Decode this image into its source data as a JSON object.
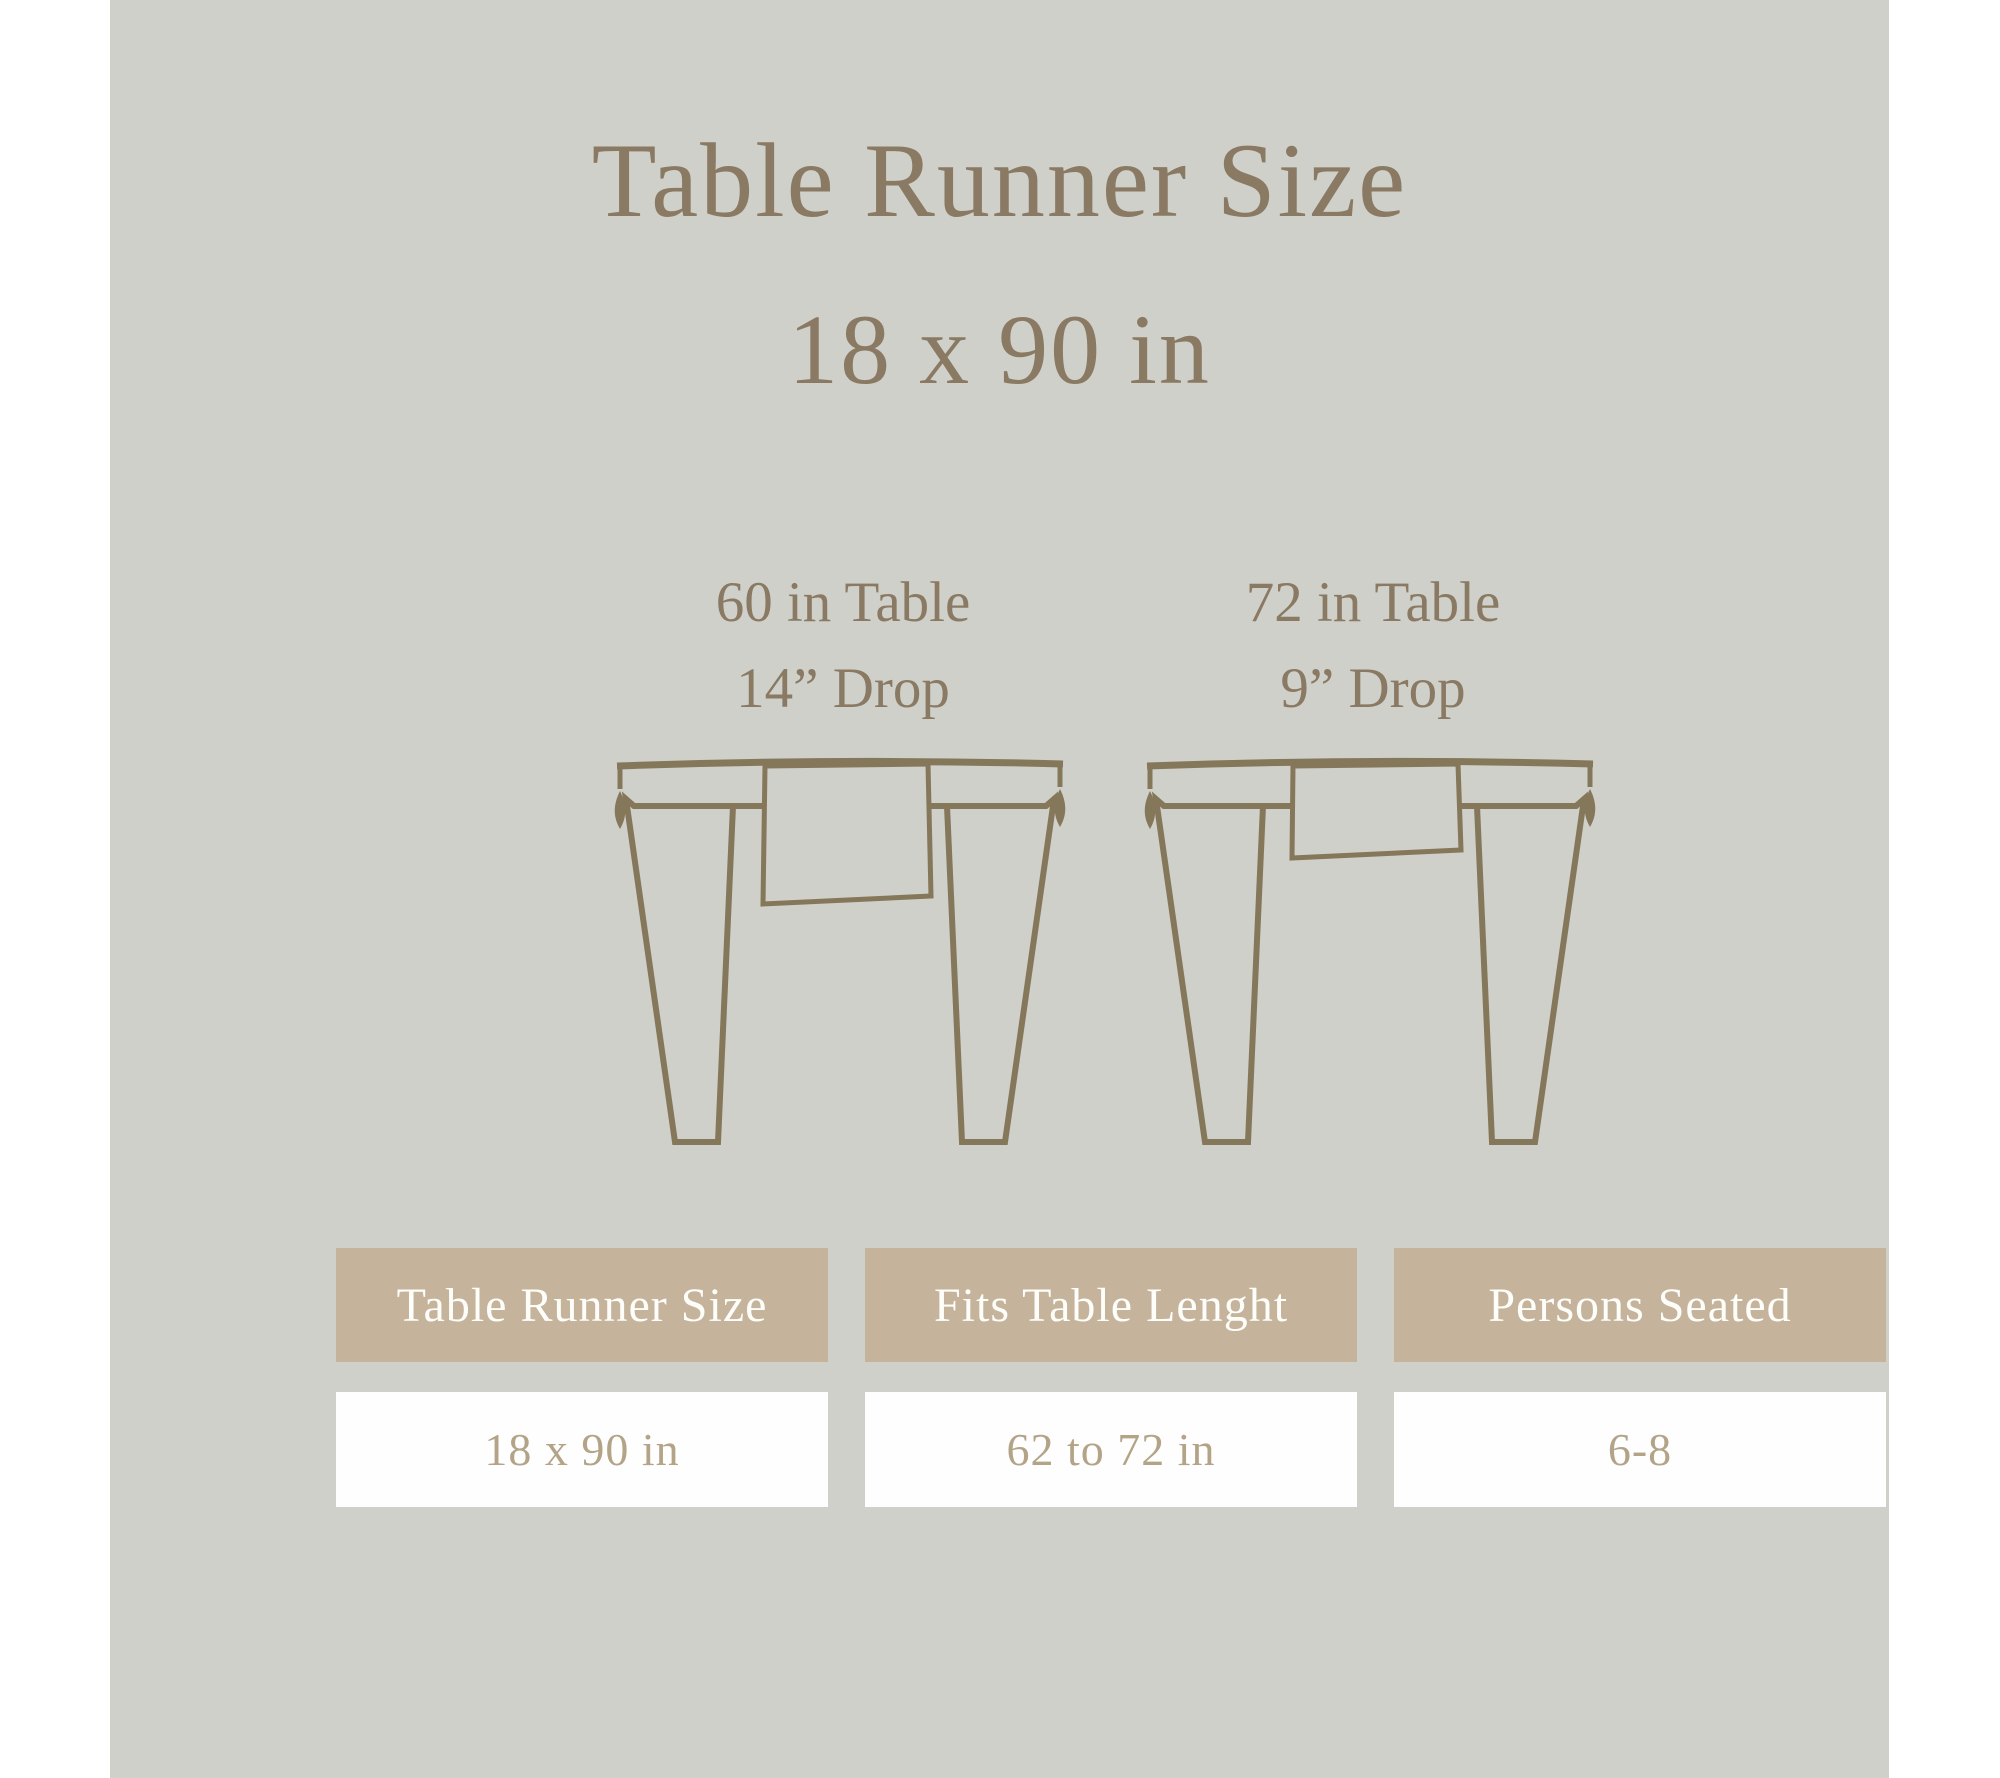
{
  "page": {
    "title_line1": "Table Runner Size",
    "title_line2": "18 x 90 in"
  },
  "diagrams": [
    {
      "table_label": "60 in Table",
      "drop_label": "14” Drop"
    },
    {
      "table_label": "72 in Table",
      "drop_label": "9” Drop"
    }
  ],
  "size_table": {
    "headers": [
      "Table Runner Size",
      "Fits Table Lenght",
      "Persons Seated"
    ],
    "row": [
      "18 x 90 in",
      "62 to 72 in",
      "6-8"
    ]
  },
  "colors": {
    "panel_background": "#cfd0ca",
    "page_margin": "#ffffff",
    "accent_brown": "#8a7a63",
    "illustration_stroke": "#85775a",
    "header_cell_background": "#c5b49b",
    "header_cell_text": "#fdfdfa",
    "value_cell_background": "#fefefe",
    "value_cell_text": "#b3a488"
  }
}
